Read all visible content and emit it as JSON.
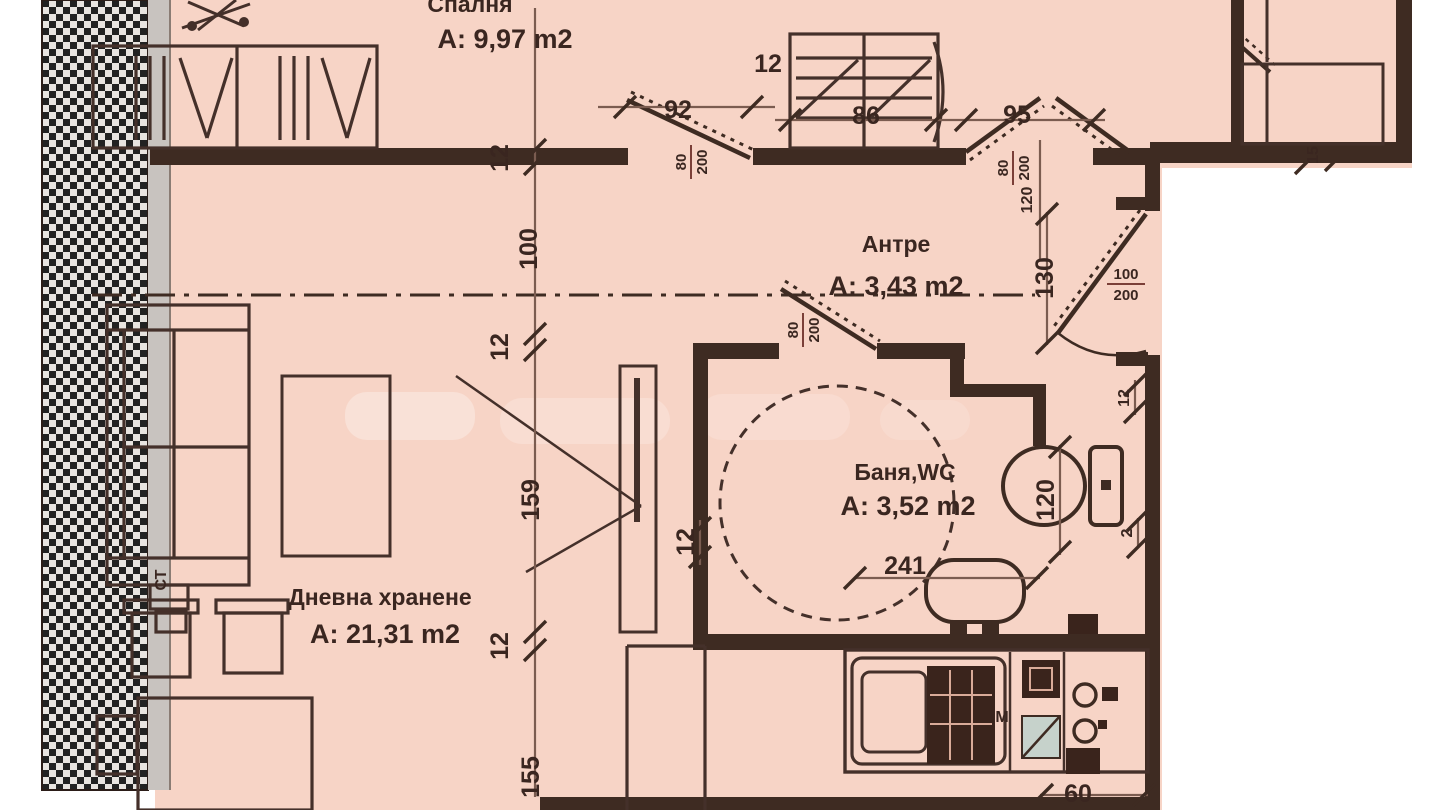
{
  "plan_title": "apartment-floor-plan",
  "rooms": {
    "bedroom": {
      "name": "Спалня",
      "area": "A: 9,97 m2"
    },
    "hall": {
      "name": "Антре",
      "area": "A: 3,43 m2"
    },
    "bath": {
      "name": "Баня,WC",
      "area": "A: 3,52 m2"
    },
    "living": {
      "name": "Дневна хранене",
      "area": "A: 21,31 m2"
    }
  },
  "dims": {
    "chain": [
      "12",
      "100",
      "12",
      "159",
      "12",
      "155"
    ],
    "top": [
      "92",
      "12",
      "86",
      "95"
    ],
    "hall_130": "130",
    "hall_120": "120",
    "wc_120": "120",
    "bath_12": "12",
    "wall_12": "12",
    "wall_2": "2",
    "balcony_15": "15",
    "basin_241": "241",
    "kitchen_60": "60",
    "frac_bedroom": {
      "num": "80",
      "den": "200"
    },
    "frac_hall": {
      "num": "80",
      "den": "200"
    },
    "frac_bath": {
      "num": "80",
      "den": "200"
    },
    "frac_entry": {
      "num": "100",
      "den": "200"
    }
  },
  "labels": {
    "sofa_table": "СТ",
    "stove": "М"
  },
  "colors": {
    "background": "#f7d4c6",
    "wall": "#3e2b22",
    "furniture": "#44302a",
    "dimension_line": "#7b5c50",
    "outside": "#ffffff",
    "gray_strip": "#c8c3bf",
    "appliance_teal": "#c6d2cb"
  }
}
